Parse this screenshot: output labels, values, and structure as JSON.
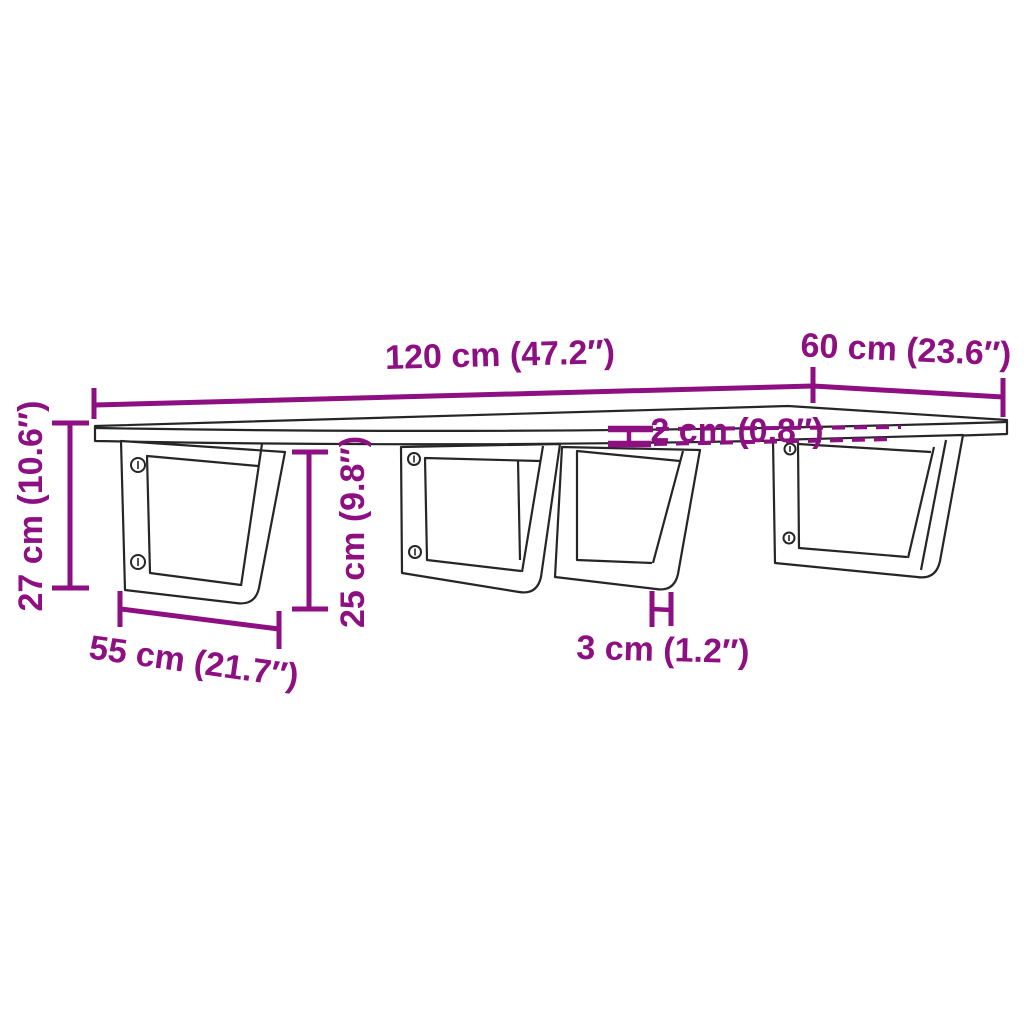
{
  "diagram": {
    "description": "Dimension drawing of a wall-mounted shelf board supported by four trapezoid steel brackets",
    "colors": {
      "dimension_accent": "#8D0F82",
      "outline": "#262626",
      "background": "#ffffff"
    },
    "labels": {
      "shelf_length": "120 cm (47.2″)",
      "shelf_depth": "60 cm (23.6″)",
      "shelf_thickness": "2 cm (0.8″)",
      "total_height": "27 cm (10.6″)",
      "bracket_height": "25 cm (9.8″)",
      "bracket_depth": "55 cm (21.7″)",
      "bracket_bar_width": "3 cm (1.2″)"
    }
  }
}
